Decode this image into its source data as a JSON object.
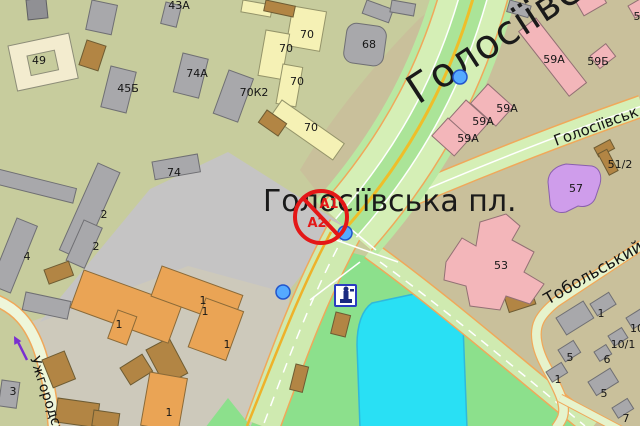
{
  "map": {
    "place_label": "Голосіївська пл.",
    "streets": {
      "avenue": "Голосіївськ",
      "avenue_right": "Голосіївськ",
      "tobolskyi": "Тобольський",
      "uzhhorodska": "Ужгородськ"
    },
    "restriction_marker": {
      "line1": "А1",
      "line2": "А2"
    },
    "building_labels": [
      "49",
      "45Б",
      "74А",
      "43А",
      "70",
      "70",
      "70",
      "70",
      "70К2",
      "68",
      "74",
      "2",
      "2",
      "4",
      "3",
      "59А",
      "59Б",
      "5",
      "59А",
      "59А",
      "59А",
      "57",
      "51/2",
      "53",
      "1",
      "1",
      "1",
      "1",
      "1",
      "1",
      "5",
      "1",
      "10",
      "10/1",
      "6",
      "5",
      "7"
    ],
    "icons": [
      "monument-icon",
      "one-way-arrow-icon",
      "poi-marker-icon",
      "restriction-icon"
    ],
    "colors": {
      "background_west": "#c7cc9d",
      "background_east": "#c9c09b",
      "paved_square": "#c5c4c4",
      "ground_yard": "#cdc9bb",
      "park": "#8ce08c",
      "water": "#29e0f4",
      "road": "#d5efb6",
      "road_median": "#abe498",
      "road_edge": "#f0a85a",
      "road_yellow_line": "#eebe2a",
      "restriction_red": "#e41717",
      "poi_blue": "#55aaff",
      "one_way_purple": "#7a2fd0"
    }
  }
}
